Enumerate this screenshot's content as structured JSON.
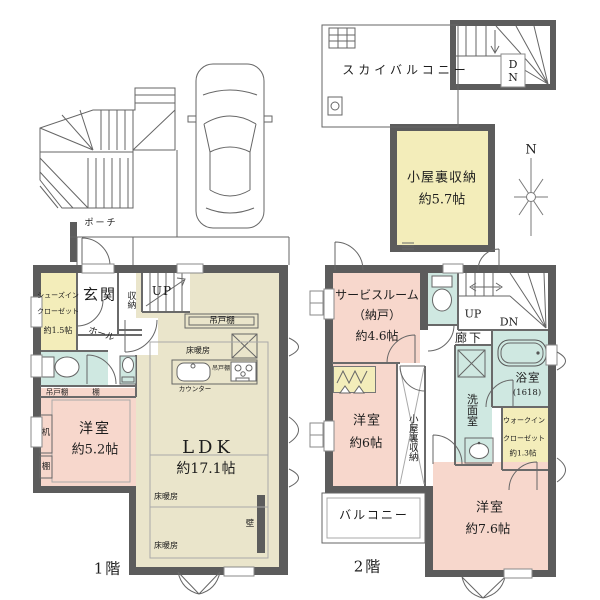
{
  "colors": {
    "wall": "#5c5c5c",
    "room_pink": "#f7d7cc",
    "room_khaki": "#eae5cb",
    "room_yellow": "#f3edba",
    "room_teal": "#cfe8e1"
  },
  "site": {
    "porch": "ポーチ"
  },
  "sky": {
    "balcony": "スカイバルコニー",
    "dn": "DN",
    "attic_name": "小屋裏収納",
    "attic_size": "約5.7帖",
    "compass": "N"
  },
  "floor1": {
    "label": "1階",
    "shoes_closet_1": "シューズイン",
    "shoes_closet_2": "クローゼット",
    "shoes_closet_3": "約1.5帖",
    "entrance": "玄関",
    "storage": "収納",
    "up": "UP",
    "hall": "ホール",
    "hanging_cupboard_kitchen": "吊戸棚",
    "hanging_cupboard_stove": "吊戸棚",
    "hanging_cupboard_west": "吊戸棚",
    "shelf_top": "棚",
    "desk": "机",
    "shelf_side": "棚",
    "floor_heating_1": "床暖房",
    "floor_heating_2": "床暖房",
    "floor_heating_3": "床暖房",
    "counter": "カウンター",
    "western_room_name": "洋室",
    "western_room_size": "約5.2帖",
    "ldk_name": "LDK",
    "ldk_size": "約17.1帖",
    "wall_note": "壁"
  },
  "floor2": {
    "label": "2階",
    "service_room_1": "サービスルーム",
    "service_room_2": "（納戸）",
    "service_room_3": "約4.6帖",
    "up": "UP",
    "dn": "DN",
    "corridor": "廊下",
    "bath_name": "浴室",
    "bath_size": "(1618)",
    "washroom": "洗面室",
    "wic_1": "ウォークイン",
    "wic_2": "クローゼット",
    "wic_3": "約1.3帖",
    "western_room_6_name": "洋室",
    "western_room_6_size": "約6帖",
    "attic_access": "小屋裏収納",
    "western_room_76_name": "洋室",
    "western_room_76_size": "約7.6帖",
    "balcony": "バルコニー"
  }
}
